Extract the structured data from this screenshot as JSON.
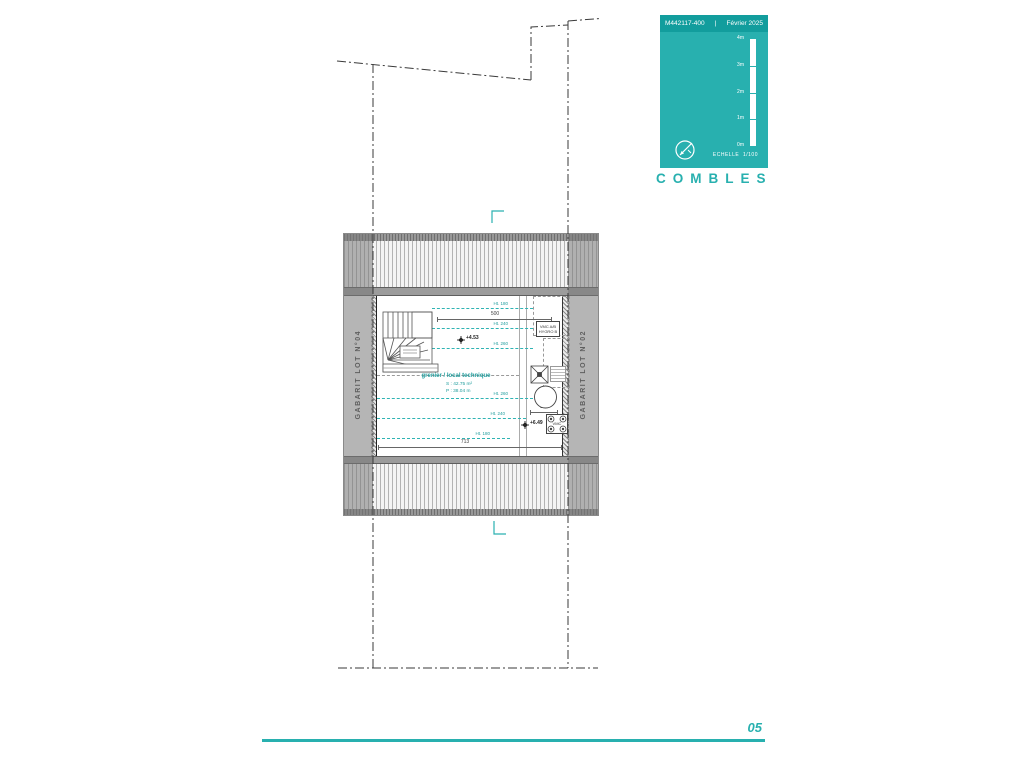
{
  "page": {
    "number": "05",
    "accent_color": "#28b0af"
  },
  "title_block": {
    "ref": "M442117-400",
    "separator": "|",
    "date": "Février 2025",
    "scale_ticks": [
      "4m",
      "3m",
      "2m",
      "1m",
      "0m"
    ],
    "scale_label": "ECHELLE",
    "scale_value": "1/100",
    "sheet_title": "COMBLES"
  },
  "plan": {
    "gabarit_left": "GABARIT LOT N°04",
    "gabarit_right": "GABARIT LOT N°02",
    "room": {
      "name": "grenier / local technique",
      "surface": "S : 42.75 m²",
      "perimeter": "P : 38.04 m"
    },
    "levels": {
      "ridge": "+4.53",
      "roof": "+6.49"
    },
    "height_lines": [
      {
        "label": "Ht. 180"
      },
      {
        "label": "Ht. 240"
      },
      {
        "label": "Ht. 260"
      },
      {
        "label": "Ht. 260"
      },
      {
        "label": "Ht. 240"
      },
      {
        "label": "Ht. 180"
      }
    ],
    "dimensions": {
      "stair": "208",
      "upper": "500",
      "room": "713",
      "duct": "173"
    },
    "equipment": {
      "vmc_line1": "VMC A/B",
      "vmc_line2": "HYGRO B",
      "outlet": "VMC",
      "duct_diameter": "Ø160"
    }
  }
}
